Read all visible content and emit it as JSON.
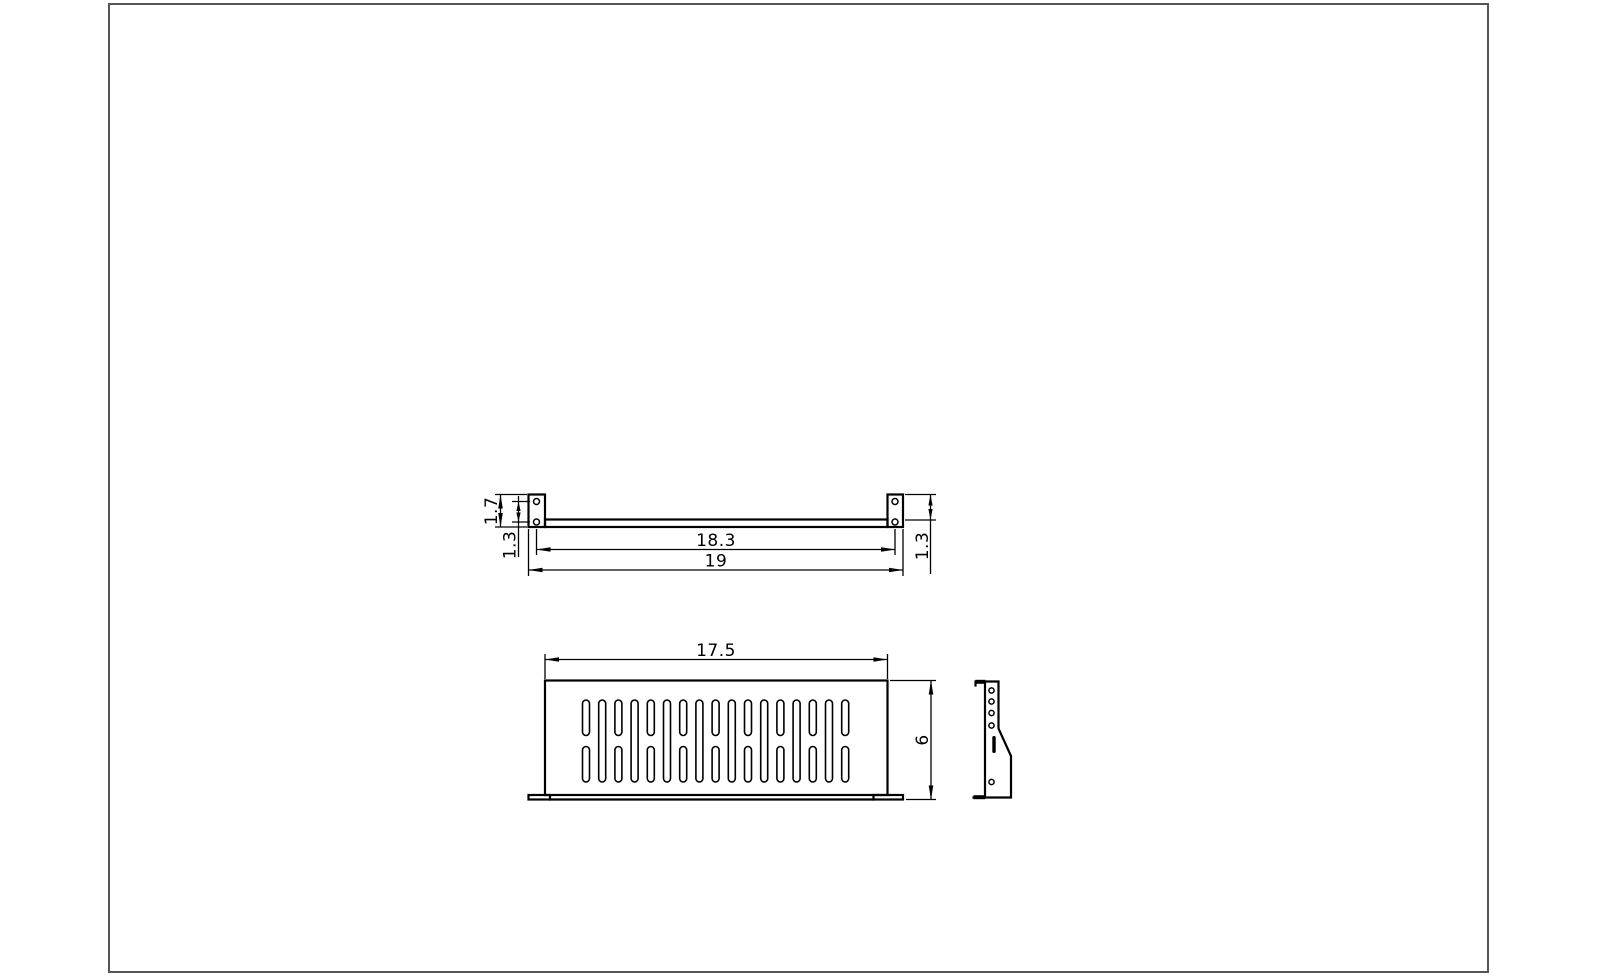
{
  "colors": {
    "line": "#000000",
    "background": "#ffffff",
    "border": "#555555"
  },
  "dimensions": {
    "front_ear_height": "1.7",
    "front_hole_pitch": "1.3",
    "front_hole_span": "18.3",
    "front_overall_width": "19",
    "front_right_offset": "1.3",
    "plan_width": "17.5",
    "plan_depth": "6"
  }
}
